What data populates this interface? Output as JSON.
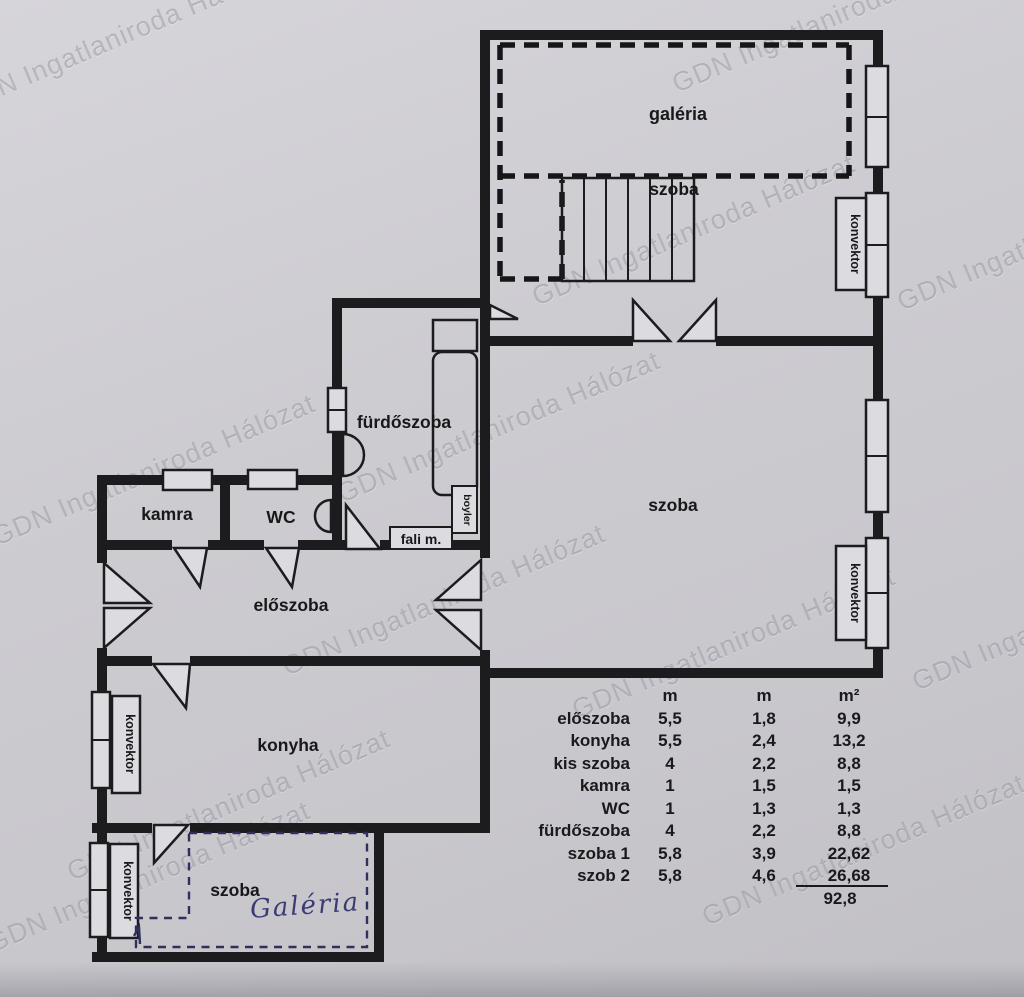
{
  "watermark": {
    "text": "GDN Ingatlaniroda Hálózat"
  },
  "plan": {
    "labels": {
      "galeria": "galéria",
      "szoba_upper": "szoba",
      "furdoszoba": "fürdőszoba",
      "kamra": "kamra",
      "wc": "WC",
      "fali_m": "fali m.",
      "boyler": "boyler",
      "eloszoba": "előszoba",
      "konyha": "konyha",
      "szoba_main": "szoba",
      "szoba_lower": "szoba",
      "galeria_handwritten": "Galéria",
      "konvektor": "konvektor"
    }
  },
  "table": {
    "col_headers": [
      "m",
      "m",
      "m²"
    ],
    "rows": [
      {
        "name": "előszoba",
        "m1": "5,5",
        "m2": "1,8",
        "area": "9,9"
      },
      {
        "name": "konyha",
        "m1": "5,5",
        "m2": "2,4",
        "area": "13,2"
      },
      {
        "name": "kis szoba",
        "m1": "4",
        "m2": "2,2",
        "area": "8,8"
      },
      {
        "name": "kamra",
        "m1": "1",
        "m2": "1,5",
        "area": "1,5"
      },
      {
        "name": "WC",
        "m1": "1",
        "m2": "1,3",
        "area": "1,3"
      },
      {
        "name": "fürdőszoba",
        "m1": "4",
        "m2": "2,2",
        "area": "8,8"
      },
      {
        "name": "szoba 1",
        "m1": "5,8",
        "m2": "3,9",
        "area": "22,62"
      },
      {
        "name": "szob 2",
        "m1": "5,8",
        "m2": "4,6",
        "area": "26,68"
      }
    ],
    "total": "92,8"
  }
}
